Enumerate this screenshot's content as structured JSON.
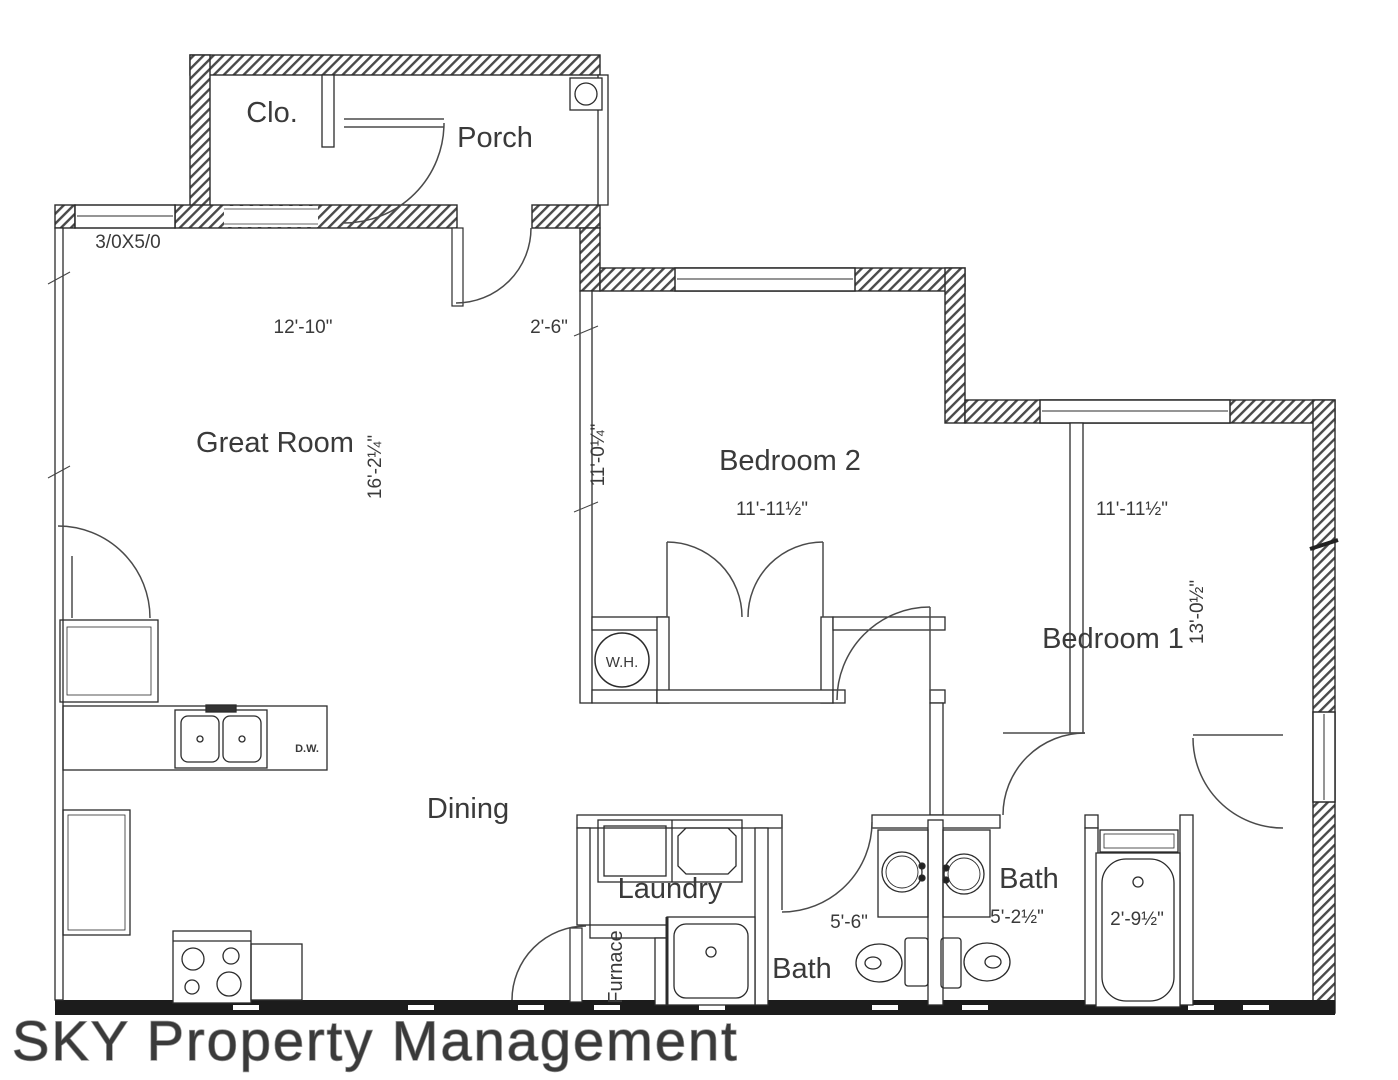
{
  "plan": {
    "type": "residential-floor-plan",
    "rooms": {
      "porch": "Porch",
      "closet": "Clo.",
      "great_room": "Great Room",
      "bedroom2": "Bedroom 2",
      "bedroom1": "Bedroom 1",
      "dining": "Dining",
      "laundry": "Laundry",
      "furnace": "Furnace",
      "bath1": "Bath",
      "bath2": "Bath"
    },
    "fixtures": {
      "water_heater": "W.H.",
      "dishwasher": "D.W."
    },
    "dimensions": {
      "window_schedule": "3/0X5/0",
      "great_room_width": "12'-10\"",
      "front_door": "2'-6\"",
      "great_room_depth": "16'-2¼\"",
      "bedroom2_width": "11'-11½\"",
      "bedroom2_depth": "11'-0¼\"",
      "bedroom1_width": "11'-11½\"",
      "bedroom1_depth": "13'-0½\"",
      "bath1_width": "5'-6\"",
      "bath2_width": "5'-2½\"",
      "tub_width": "2'-9½\""
    },
    "watermark": "SKY Property Management",
    "colors": {
      "line": "#2b2b2b",
      "arc": "#4a4a4a",
      "watermark_fill": "#f7f7f7",
      "watermark_stroke": "#9a9a9a"
    }
  }
}
